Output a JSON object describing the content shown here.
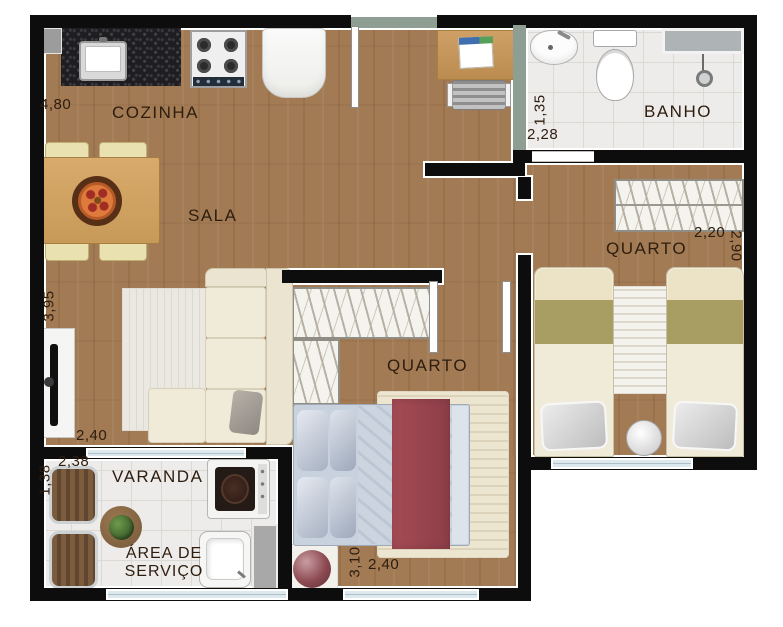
{
  "rooms": {
    "cozinha": "COZINHA",
    "sala": "SALA",
    "banho": "BANHO",
    "quarto1": "QUARTO",
    "quarto2": "QUARTO",
    "varanda": "VARANDA",
    "area_servico": "ÁREA DE SERVIÇO"
  },
  "dims": {
    "cozinha_w": "4,80",
    "sala_v": "3,95",
    "sala_h": "2,40",
    "varanda_v": "1,38",
    "varanda_h": "2,38",
    "banho_v": "1,35",
    "banho_h": "2,28",
    "quarto2_h": "2,20",
    "quarto2_v": "2,90",
    "quarto1_v": "3,10",
    "quarto1_h": "2,40"
  },
  "colors": {
    "wall": "#0d0d0d",
    "wet_wall": "#8e9e93",
    "wood_floor": "#a27a54",
    "tile_floor": "#edecea",
    "window_glass": "#dde9ee",
    "blanket_red": "#9e4450",
    "bed_olive": "#a89d62",
    "label_text": "#2e1d0e"
  }
}
